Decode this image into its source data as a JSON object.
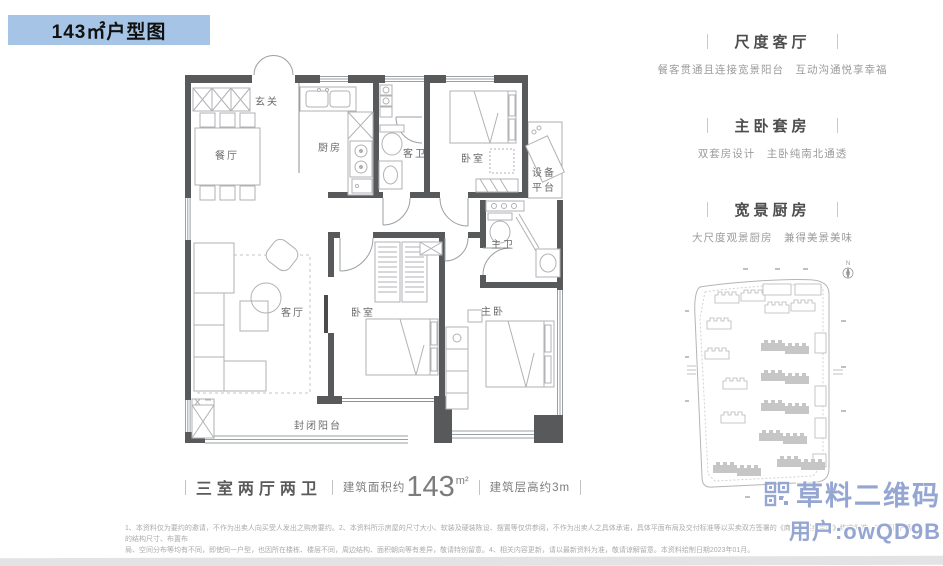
{
  "banner": {
    "title": "143㎡户型图"
  },
  "rooms": {
    "entry": "玄关",
    "dining": "餐厅",
    "kitchen": "厨房",
    "guest_bath": "客卫",
    "bedroom_top": "卧室",
    "equipment_1": "设备",
    "equipment_2": "平台",
    "master_bath": "主卫",
    "living": "客厅",
    "bedroom_mid": "卧室",
    "master_bedroom": "主卧",
    "balcony": "封闭阳台"
  },
  "features": [
    {
      "title": "尺度客厅",
      "desc": "餐客贯通且连接宽景阳台　互动沟通悦享幸福"
    },
    {
      "title": "主卧套房",
      "desc": "双套房设计　主卧纯南北通透"
    },
    {
      "title": "宽景厨房",
      "desc": "大尺度观景厨房　兼得美景美味"
    }
  ],
  "summary": {
    "layout": "三室两厅两卫",
    "area_prefix": "建筑面积约",
    "area_value": "143",
    "area_unit": "m²",
    "floor_height": "建筑层高约3m"
  },
  "siteplan": {
    "north": "N"
  },
  "disclaimer": {
    "line1": "1、本资料仅为要约的邀请，不作为出卖人向买受人发出之购房要约。2、本资料所示房屋的尺寸大小、软装及硬装陈设、摆置等仅供参阅，不作为出卖人之具体承诺，具体平面布局及交付标准等以买卖双方签署的《商品房买卖合同》约定为准。3、不同户型的结构尺寸、布置布",
    "line2": "局、空间分布等均有不同，即使同一户型，也因所在楼栋、楼层不同，周边结构、面积朝向等有差异，敬请特别留意。4、相关内容更新，请以最新资料为准，敬请谅解留意。本资料绘制日期2023年01月。"
  },
  "watermark": {
    "brand": "草料二维码",
    "user": "用户:owQD9B"
  },
  "colors": {
    "banner_bg": "#a6c5e6",
    "wall": "#58595b",
    "furniture": "#b2b2b5",
    "watermark": "#94a6d1"
  }
}
